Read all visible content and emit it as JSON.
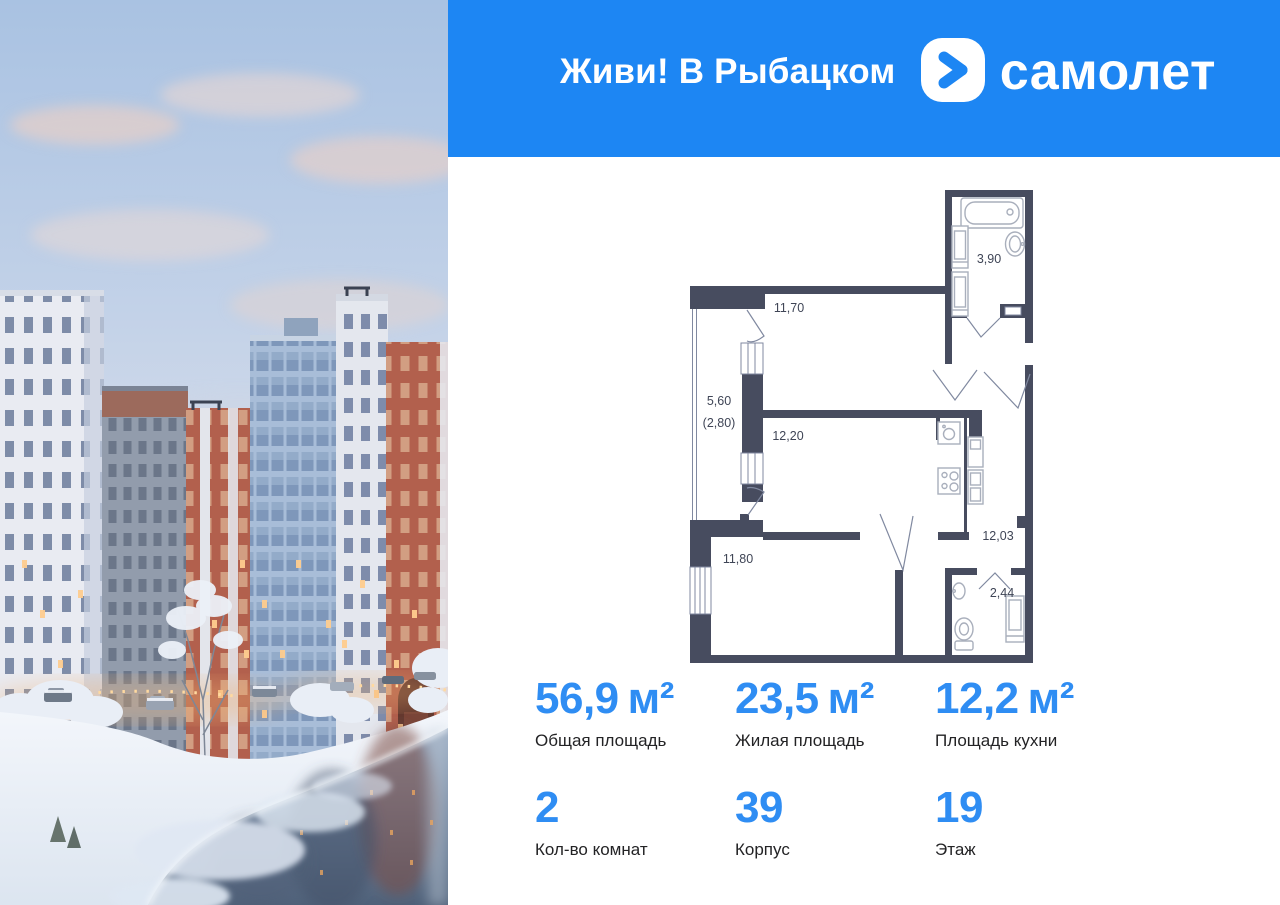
{
  "colors": {
    "header_blue": "#1d86f3",
    "stat_number_blue": "#2f8df3",
    "plan_wall": "#474c5f",
    "plan_furniture": "#a9afbc"
  },
  "header": {
    "project_title": "Живи! В Рыбацком",
    "brand_name": "самолет"
  },
  "floor_plan": {
    "rooms": [
      {
        "id": "bathroom",
        "area": "3,90"
      },
      {
        "id": "room-1",
        "area": "11,70"
      },
      {
        "id": "balcony",
        "area": "5,60",
        "area_reduced": "(2,80)"
      },
      {
        "id": "room-2",
        "area": "12,20"
      },
      {
        "id": "room-3",
        "area": "11,80"
      },
      {
        "id": "hallway",
        "area": "12,03"
      },
      {
        "id": "wc",
        "area": "2,44"
      }
    ]
  },
  "stats": {
    "cells": [
      {
        "value": "56,9",
        "unit": "м²",
        "label": "Общая площадь"
      },
      {
        "value": "23,5",
        "unit": "м²",
        "label": "Жилая площадь"
      },
      {
        "value": "12,2",
        "unit": "м²",
        "label": "Площадь кухни"
      },
      {
        "value": "2",
        "unit": "",
        "label": "Кол-во комнат"
      },
      {
        "value": "39",
        "unit": "",
        "label": "Корпус"
      },
      {
        "value": "19",
        "unit": "",
        "label": "Этаж"
      }
    ]
  }
}
